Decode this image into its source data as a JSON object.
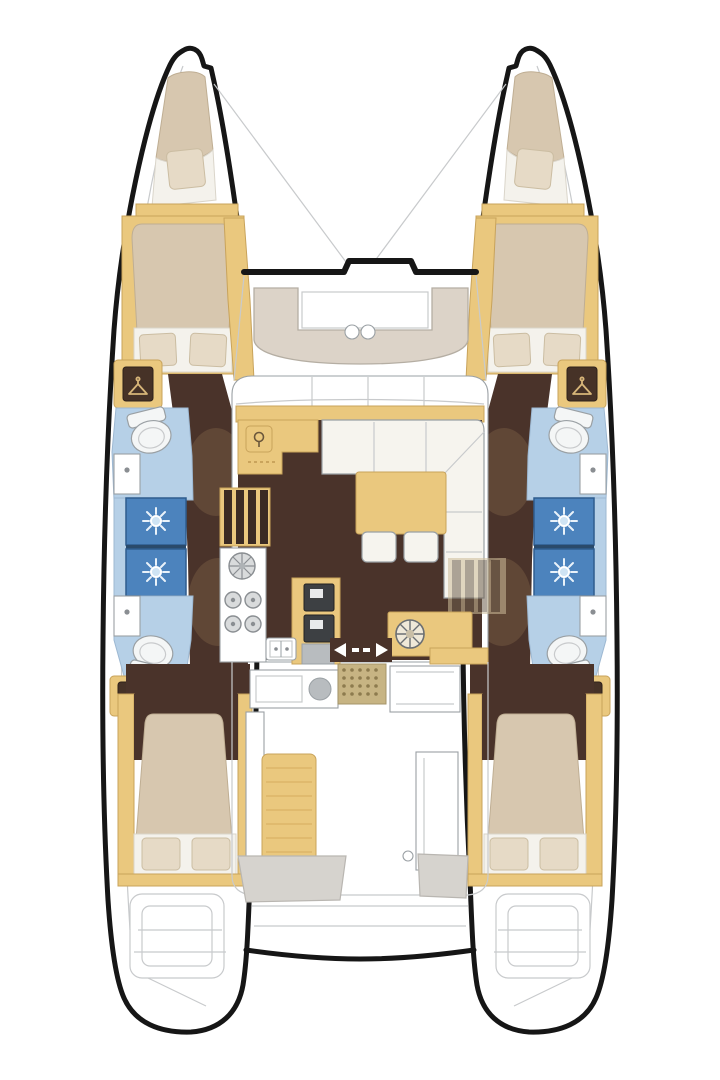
{
  "palette": {
    "outline": "#161616",
    "faint_line": "#c8cacc",
    "furniture_line": "#9aa0a4",
    "wood": "#eac87e",
    "wood_dark": "#c8a35b",
    "wood_plank": "#d9b265",
    "floor": "#4a332a",
    "floor_shadow": "#7d5f45",
    "mattress": "#d7c7af",
    "pillow": "#e6dac6",
    "linen": "#f4f2ec",
    "sofa": "#f6f4ee",
    "lounge": "#dcd3c8",
    "bath": "#b6d0e7",
    "shower": "#4c83bd",
    "shower_trim": "#2e5c8e",
    "shower_icon": "#e9f2fa",
    "appliance": "#3d4043",
    "steel": "#b8bcbf",
    "gray_seat": "#d6d3ce",
    "mat": "#c7b483",
    "mat_dot": "#8d7b4e",
    "toilet": "#f4f6f6",
    "deck": "#ffffff"
  },
  "icons": {
    "shower-rose-icon": "sun-with-spokes",
    "hanger-icon": "clothes-hanger",
    "stove-burner-icon": "concentric-circles",
    "round-sink-icon": "circle-with-spokes",
    "sliding-door-icon": "left-right-arrows-dashed",
    "toilet-icon": "oval-bowl-with-cistern",
    "doormat-icon": "dotted-grid"
  },
  "plan": {
    "hulls": 2,
    "double_cabins": 4,
    "forepeak_berths": 2,
    "bathrooms": 4,
    "shower_stalls": 4,
    "saloons": 1,
    "galleys": 1,
    "cockpits": 1
  }
}
